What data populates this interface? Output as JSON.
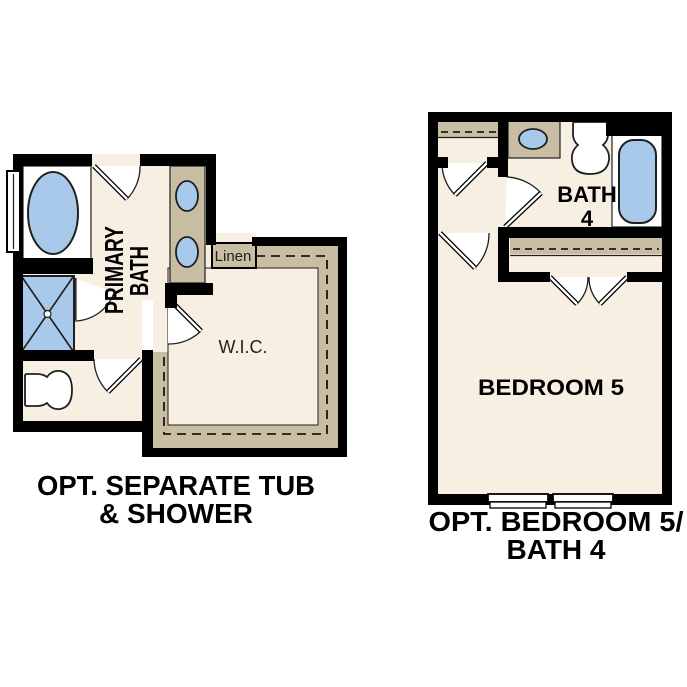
{
  "canvas": {
    "background": "#ffffff"
  },
  "colors": {
    "wall": "#000000",
    "line": "#1f1f1f",
    "floor": "#f7efe1",
    "cabinet": "#c9bda4",
    "fixture": "#a9c9ea",
    "text": "#000000"
  },
  "plan_left": {
    "caption_line1": "OPT. SEPARATE TUB",
    "caption_line2": "& SHOWER",
    "labels": {
      "primary_bath_line1": "PRIMARY",
      "primary_bath_line2": "BATH",
      "linen": "Linen",
      "wic": "W.I.C."
    },
    "fixtures": [
      "bathtub",
      "shower",
      "toilet",
      "double-sink-vanity",
      "window",
      "linen-closet",
      "walk-in-closet"
    ]
  },
  "plan_right": {
    "caption_line1": "OPT. BEDROOM 5/",
    "caption_line2": "BATH 4",
    "labels": {
      "bath_line1": "BATH",
      "bath_line2": "4",
      "bedroom": "BEDROOM 5"
    },
    "fixtures": [
      "bathtub",
      "toilet",
      "sink-vanity",
      "shelf-closet",
      "double-door-closet",
      "windows"
    ]
  }
}
